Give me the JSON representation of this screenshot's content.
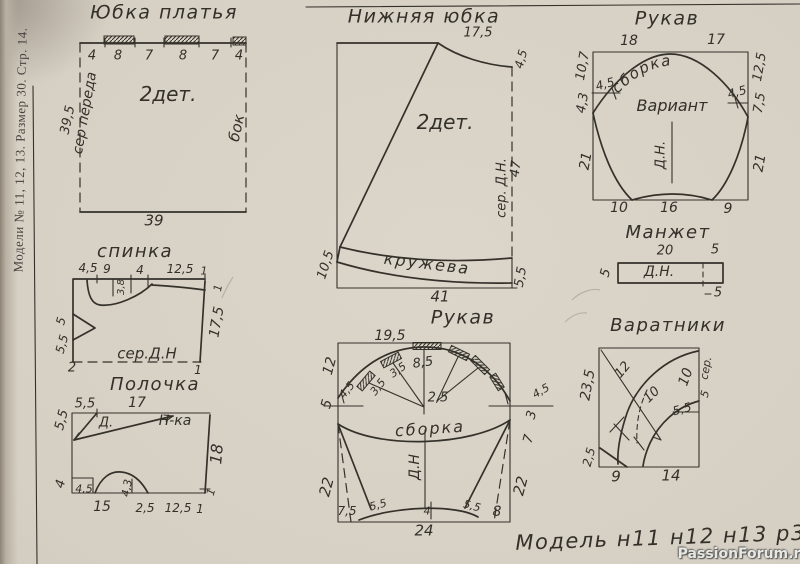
{
  "page": {
    "margin_text": "Модели № 11, 12, 13. Размер 30. Стр. 14.",
    "caption": "Модель н11 н12 н13 р30",
    "watermark": "PassionForum.ru",
    "paper_color": "#d6d0c4",
    "ink_color": "#34312b"
  },
  "skirt": {
    "title": "Юбка платья",
    "top_dims": [
      "4",
      "8",
      "7",
      "8",
      "7",
      "4"
    ],
    "left_dim": "39,5",
    "left_edge_label": "сер переда",
    "right_edge_label": "бок",
    "pieces_label": "2дет.",
    "bottom_dim": "39"
  },
  "underskirt": {
    "title": "Нижняя юбка",
    "top_dim": "17,5",
    "right_top_dim": "4,5",
    "pieces_label": "2дет.",
    "right_edge_label": "сер. Д.Н.",
    "right_dim": "47",
    "band_label": "кружева",
    "left_bottom_dim": "10,5",
    "right_bottom_dim": "5,5",
    "bottom_dim": "41"
  },
  "sleeve_top": {
    "title": "Рукав",
    "top_dims": [
      "18",
      "17"
    ],
    "left_dims": [
      "10,7",
      "4,3",
      "21"
    ],
    "right_dims": [
      "12,5",
      "7,5",
      "21"
    ],
    "notch_left": "4,5",
    "notch_right": "4,5",
    "curve_label": "сборка",
    "variant_label": "Вариант",
    "center_label": "Д.Н.",
    "bottom_dims": [
      "10",
      "16",
      "9"
    ]
  },
  "cuff": {
    "title": "Манжет",
    "top_dims": [
      "20",
      "5"
    ],
    "left_dim": "5",
    "center_label": "Д.Н.",
    "bottom_right_dim": "5"
  },
  "back": {
    "title": "спинка",
    "top_dims": [
      "4,5",
      "9",
      "4",
      "12,5",
      "1"
    ],
    "neck_dim": "3,8",
    "left_dims": [
      "5",
      "5,5"
    ],
    "right_dim": "17,5",
    "right_side_top": "1",
    "bottom_corner_left": "2",
    "bottom_corner_right": "1",
    "bottom_label": "сер.Д.Н"
  },
  "front": {
    "title": "Полочка",
    "top_dims": [
      "5,5",
      "17"
    ],
    "left_dims": [
      "5,5",
      "4"
    ],
    "dart_label": "Д.",
    "line_label": "Н-ка",
    "right_dim": "18",
    "right_corner": "1",
    "bottom_dims": [
      "4,5",
      "15",
      "4,3",
      "2,5",
      "12,5",
      "1"
    ]
  },
  "sleeve_bottom": {
    "title": "Рукав",
    "top_dim": "19,5",
    "left_dims": [
      "12",
      "5",
      "22"
    ],
    "right_dims": [
      "3",
      "7",
      "22"
    ],
    "notch_left": "4,5",
    "notch_right": "4,5",
    "pleat_dims": [
      "3,5",
      "3,5",
      "8,5"
    ],
    "center_dim": "2,5",
    "curve_label": "сборка",
    "center_label": "Д.Н",
    "bottom_dims": [
      "7,5",
      "5,5",
      "4",
      "5,5",
      "8"
    ],
    "bottom_total": "24"
  },
  "collars": {
    "title": "Варатники",
    "diag_dim": "12",
    "inner_dim": "10",
    "right_dim": "10",
    "stand_dim": "5,5",
    "fold_label": "сер.",
    "fold_dim": "5",
    "left_dim": "23,5",
    "left_bottom_dim": "2,5",
    "bottom_dims": [
      "9",
      "14"
    ]
  }
}
